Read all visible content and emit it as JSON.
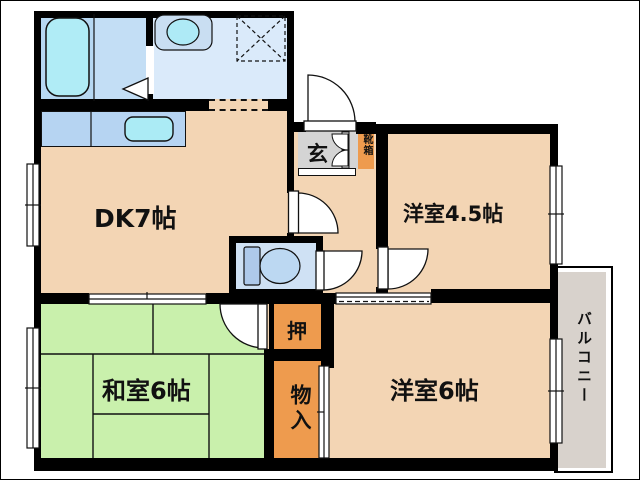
{
  "plan": {
    "rooms": {
      "dk": {
        "label": "DK7帖"
      },
      "western_room_45": {
        "label": "洋室4.5帖"
      },
      "western_room_6": {
        "label": "洋室6帖"
      },
      "japanese_room_6": {
        "label": "和室6帖"
      },
      "entrance": {
        "label": "玄"
      },
      "shoe_cabinet": {
        "label": "靴箱"
      },
      "closet": {
        "label": "押"
      },
      "storage": {
        "label": "物入"
      },
      "balcony": {
        "label": "バルコニー"
      }
    },
    "fixtures": [
      "bathtub",
      "wash-basin",
      "washing-machine-space",
      "kitchen-sink",
      "toilet"
    ],
    "colors": {
      "wall": "#000000",
      "room_floor": "#f3d5b4",
      "tatami_green": "#c9f0ac",
      "closet_orange": "#ee9b4e",
      "entrance_gray": "#d4d4d4",
      "balcony_gray": "#d8d2cc",
      "bath_blue": "#c3def5",
      "washroom_blue": "#daeafa",
      "counter_blue": "#b6d4f2",
      "water_cyan": "#aeeaf6",
      "toilet_blue": "#cfe1f4"
    }
  }
}
